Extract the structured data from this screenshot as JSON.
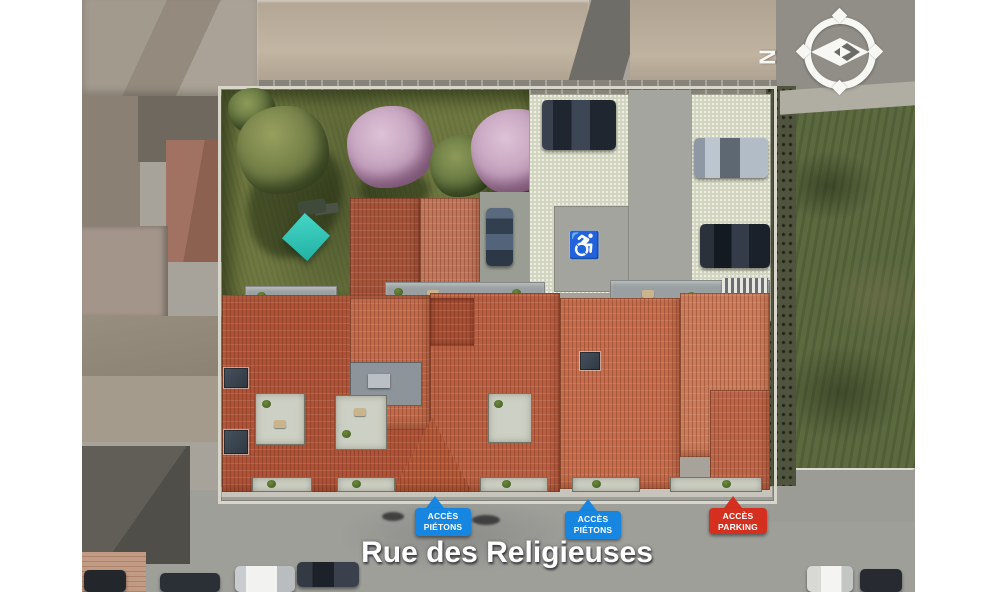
{
  "scene": {
    "description": "Aerial 3D render of a new residential building with terracotta roofs, private garden and parking, inserted in an urban block",
    "street_label": "Rue des Religieuses"
  },
  "compass": {
    "letter": "N",
    "direction": "north-left"
  },
  "overlays": {
    "signs": [
      {
        "type": "pedestrian-access",
        "line1": "ACCÈS",
        "line2": "PIÉTONS",
        "color": "#1686e0"
      },
      {
        "type": "pedestrian-access",
        "line1": "ACCÈS",
        "line2": "PIÉTONS",
        "color": "#1686e0"
      },
      {
        "type": "parking-access",
        "line1": "ACCÈS",
        "line2": "PARKING",
        "color": "#d52f1f"
      }
    ]
  },
  "icons": {
    "accessible_parking": "♿",
    "compass_needle": "diamond-needle"
  },
  "colors": {
    "sign_blue": "#1686e0",
    "sign_red": "#d52f1f",
    "roof_terracotta": "#b85c3f",
    "garden_grass": "#6f7841",
    "field_green": "#5c6a40",
    "blossom_pink": "#c3a0bd",
    "street_gray": "#9f9f9a",
    "label_text": "#ffffff",
    "margin_white": "#ffffff"
  }
}
